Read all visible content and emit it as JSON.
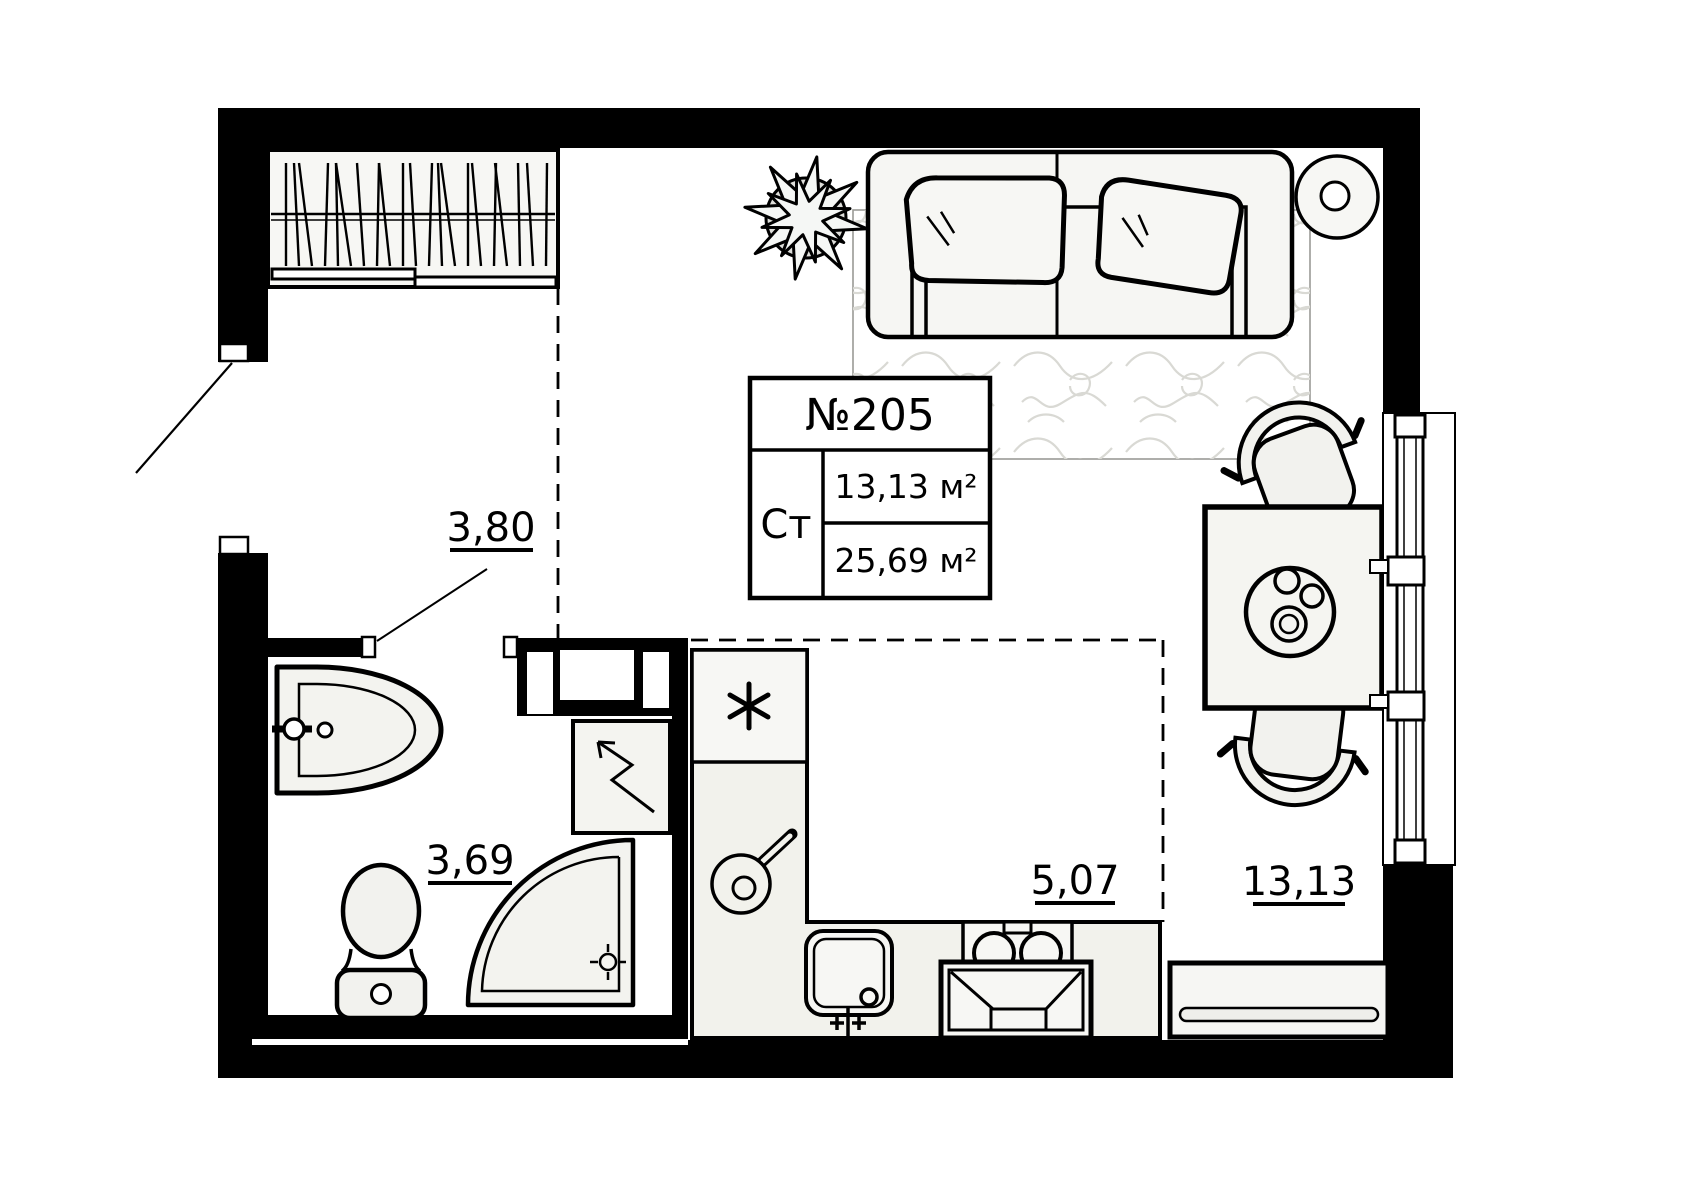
{
  "plan": {
    "unit_number": "№205",
    "unit_type": "Ст",
    "living_area": "13,13 м²",
    "total_area": "25,69 м²"
  },
  "areas": {
    "hallway": "3,80",
    "bathroom": "3,69",
    "kitchen": "5,07",
    "living_room": "13,13"
  },
  "colors": {
    "walls": "#000000",
    "lines": "#000000",
    "furniture_fill": "#f5f5f1",
    "rug_pattern": "#d9d9d4"
  }
}
